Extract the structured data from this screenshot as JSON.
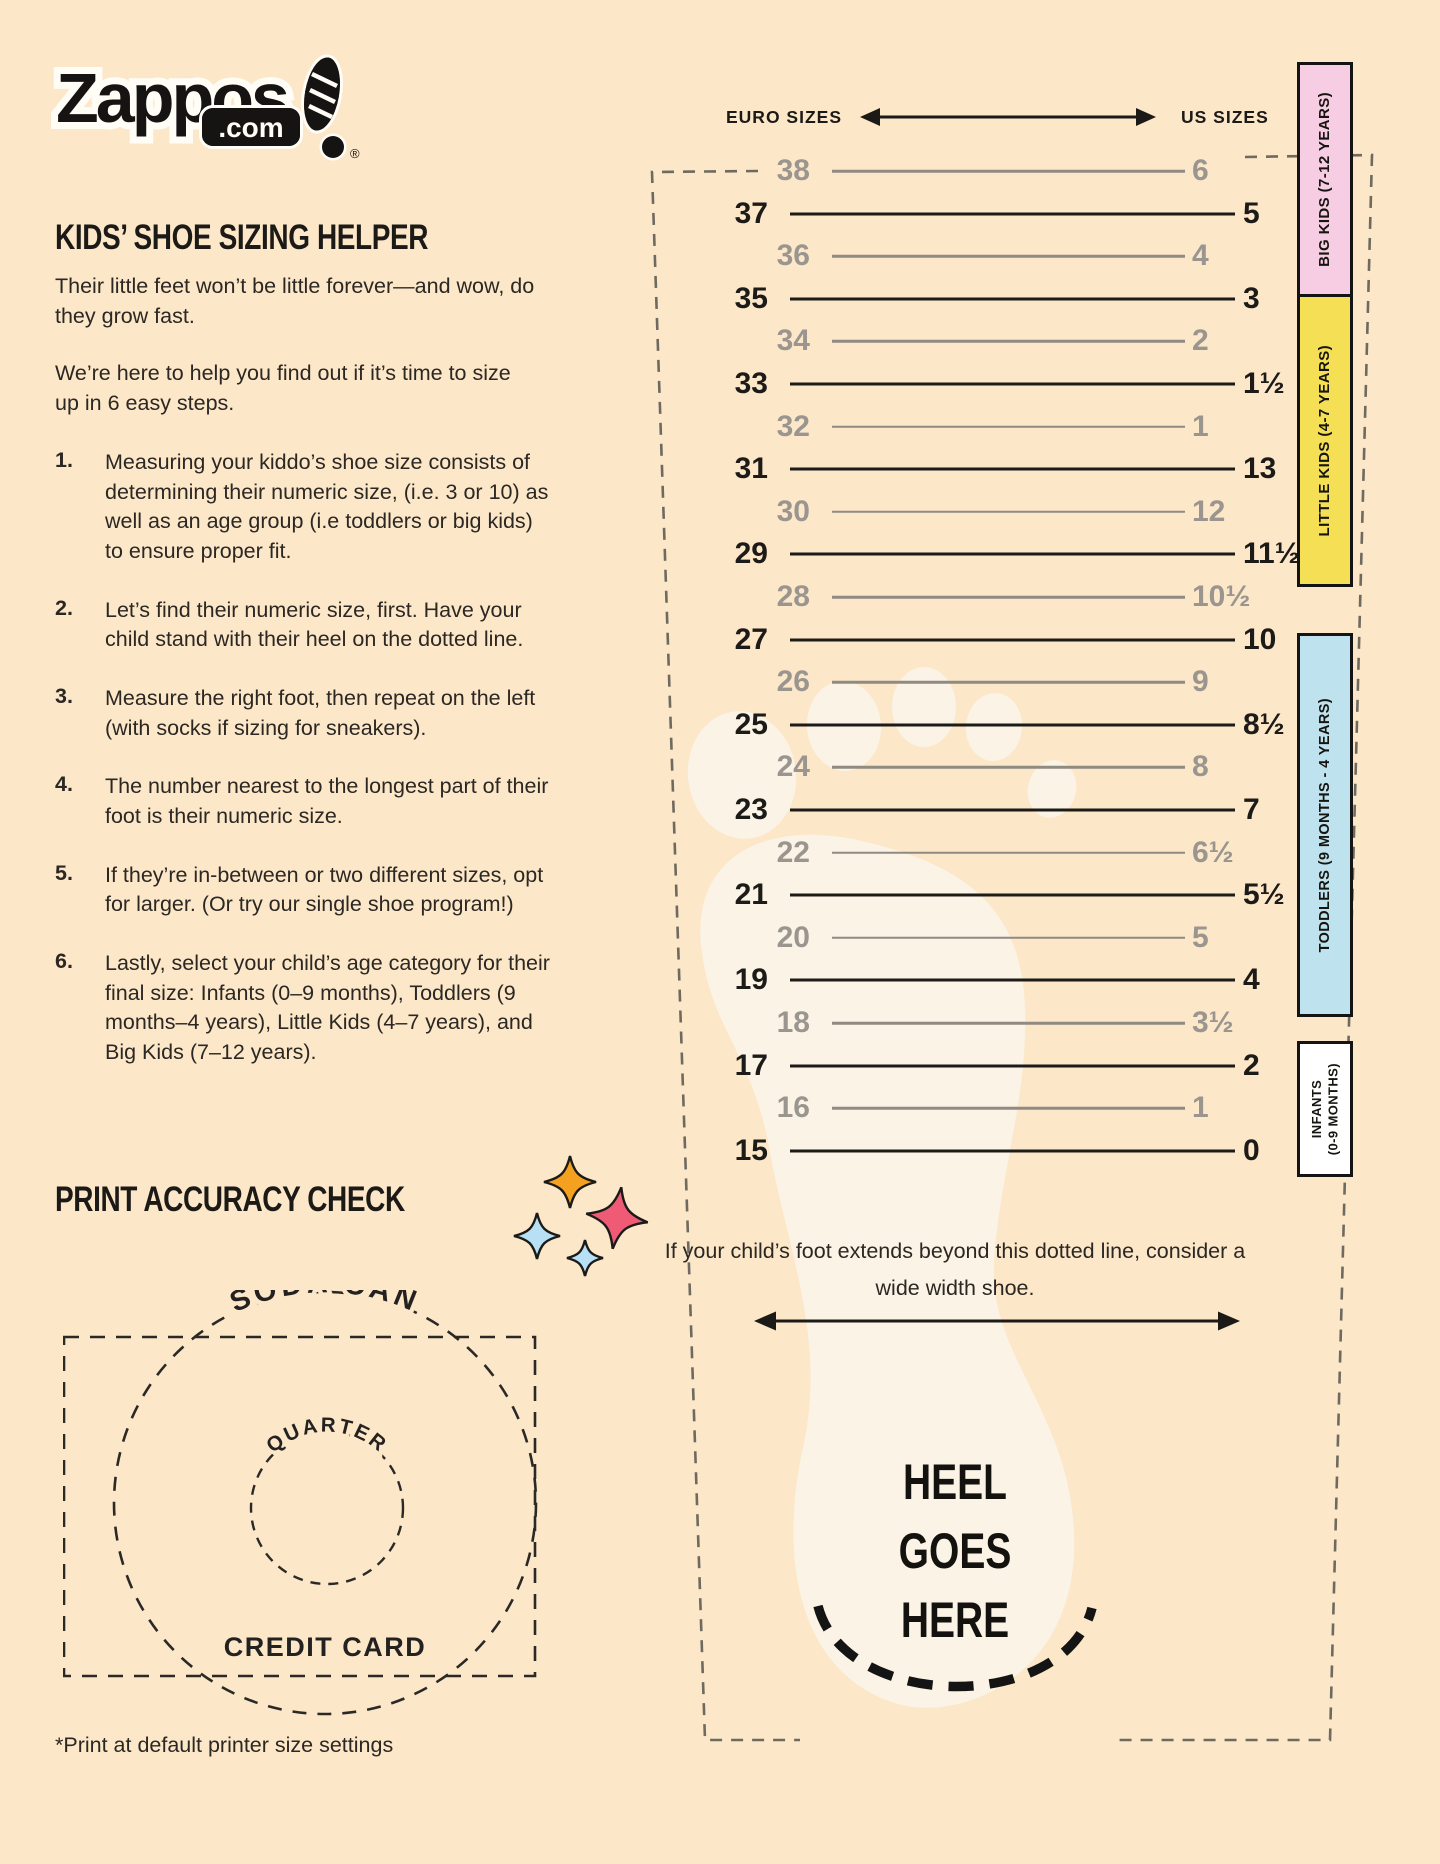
{
  "colors": {
    "background": "#fce7c9",
    "ink": "#1d1b18",
    "gray_row": "#9a958e",
    "band_big_kids": "#f7cde3",
    "band_little_kids": "#f5e055",
    "band_toddlers": "#bfe2ef",
    "band_infants": "#ffffff",
    "foot": "#faf3e6",
    "sparkle_orange": "#f4a120",
    "sparkle_pink": "#ef5a75",
    "sparkle_blue": "#b8e0f5"
  },
  "logo": {
    "brand": "Zappos",
    "domain": ".com",
    "registered": "®"
  },
  "headings": {
    "main": "KIDS’ SHOE SIZING HELPER",
    "print_check": "PRINT ACCURACY CHECK"
  },
  "intro": [
    "Their little feet won’t be little forever—and wow, do they grow fast.",
    "We’re here to help you find out if it’s time to size up in 6 easy steps."
  ],
  "steps": [
    {
      "num": "1.",
      "text": "Measuring your kiddo’s shoe size consists of determining their numeric size, (i.e. 3 or 10) as well as an age group (i.e toddlers or big kids) to ensure proper fit."
    },
    {
      "num": "2.",
      "text": "Let’s find their numeric size, first. Have your child stand with their heel on the dotted line."
    },
    {
      "num": "3.",
      "text": "Measure the right foot, then repeat on the left (with socks if sizing for sneakers)."
    },
    {
      "num": "4.",
      "text": "The number nearest to the longest part of their foot is their numeric size."
    },
    {
      "num": "5.",
      "text": "If they’re in-between or two different sizes, opt for larger. (Or try our single shoe program!)"
    },
    {
      "num": "6.",
      "text": "Lastly, select your child’s age category for their final size: Infants (0–9 months), Toddlers (9 months–4 years), Little Kids (4–7 years), and Big Kids (7–12 years)."
    }
  ],
  "ruler": {
    "euro_header": "EURO SIZES",
    "us_header": "US SIZES",
    "rows": [
      {
        "euro": "38",
        "us": "6",
        "shade": "gray"
      },
      {
        "euro": "37",
        "us": "5",
        "shade": "black"
      },
      {
        "euro": "36",
        "us": "4",
        "shade": "gray"
      },
      {
        "euro": "35",
        "us": "3",
        "shade": "black"
      },
      {
        "euro": "34",
        "us": "2",
        "shade": "gray"
      },
      {
        "euro": "33",
        "us": "1½",
        "shade": "black"
      },
      {
        "euro": "32",
        "us": "1",
        "shade": "gray"
      },
      {
        "euro": "31",
        "us": "13",
        "shade": "black"
      },
      {
        "euro": "30",
        "us": "12",
        "shade": "gray"
      },
      {
        "euro": "29",
        "us": "11½",
        "shade": "black"
      },
      {
        "euro": "28",
        "us": "10½",
        "shade": "gray"
      },
      {
        "euro": "27",
        "us": "10",
        "shade": "black"
      },
      {
        "euro": "26",
        "us": "9",
        "shade": "gray"
      },
      {
        "euro": "25",
        "us": "8½",
        "shade": "black"
      },
      {
        "euro": "24",
        "us": "8",
        "shade": "gray"
      },
      {
        "euro": "23",
        "us": "7",
        "shade": "black"
      },
      {
        "euro": "22",
        "us": "6½",
        "shade": "gray"
      },
      {
        "euro": "21",
        "us": "5½",
        "shade": "black"
      },
      {
        "euro": "20",
        "us": "5",
        "shade": "gray"
      },
      {
        "euro": "19",
        "us": "4",
        "shade": "black"
      },
      {
        "euro": "18",
        "us": "3½",
        "shade": "gray"
      },
      {
        "euro": "17",
        "us": "2",
        "shade": "black"
      },
      {
        "euro": "16",
        "us": "1",
        "shade": "gray"
      },
      {
        "euro": "15",
        "us": "0",
        "shade": "black"
      }
    ]
  },
  "age_bands": [
    {
      "label": "BIG KIDS (7-12 YEARS)",
      "color": "#f7cde3",
      "top": 62,
      "height": 235,
      "font": 15
    },
    {
      "label": "LITTLE KIDS (4-7 YEARS)",
      "color": "#f5e055",
      "top": 294,
      "height": 293,
      "font": 15
    },
    {
      "label": "TODDLERS (9 MONTHS - 4 YEARS)",
      "color": "#bfe2ef",
      "top": 633,
      "height": 384,
      "font": 14.5
    },
    {
      "label": "INFANTS\n(0-9 MONTHS)",
      "color": "#ffffff",
      "top": 1041,
      "height": 136,
      "font": 13
    }
  ],
  "measuring_area": {
    "wide_width_note": "If your child’s foot extends beyond this dotted line, consider a wide width shoe.",
    "heel_lines": [
      "HEEL",
      "GOES",
      "HERE"
    ]
  },
  "print_check": {
    "soda_can_label": "SODA CAN",
    "quarter_label": "QUARTER",
    "credit_card_label": "CREDIT CARD"
  },
  "footnote": "*Print at default printer size settings"
}
